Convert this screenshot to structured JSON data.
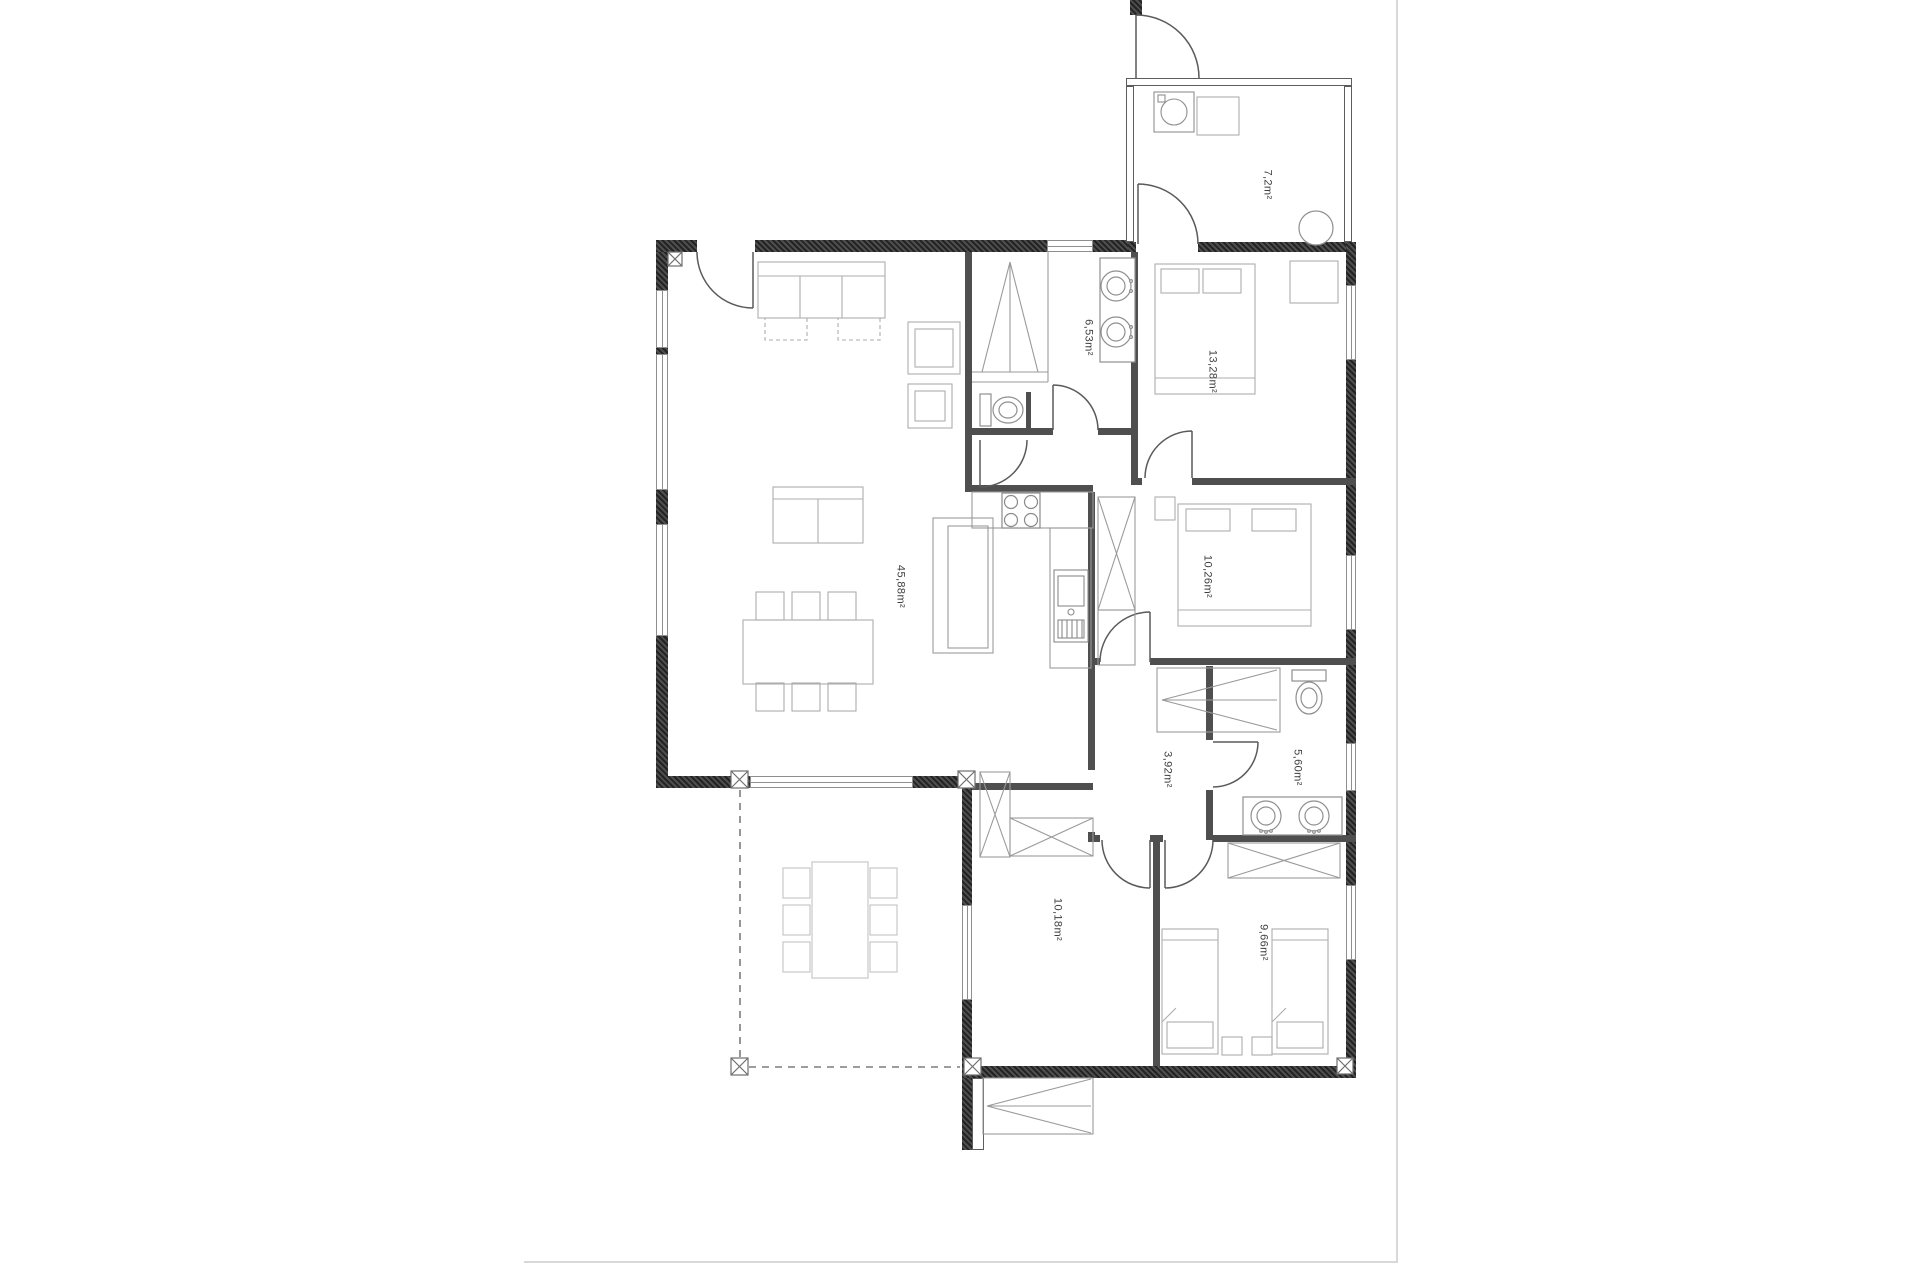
{
  "document_title": "apartment-floor-plan",
  "colors": {
    "wall": "#3a3a3a",
    "wall_interior": "#4f4f4f",
    "fixture": "#8f8f8f",
    "furniture": "#aeaeae",
    "label": "#3f3f3f",
    "boundary": "#d8d8d8",
    "dash": "#7d7d7d"
  },
  "rooms": [
    {
      "id": "living-kitchen",
      "area_label": "45,88m²"
    },
    {
      "id": "bathroom-main",
      "area_label": "6,53m²"
    },
    {
      "id": "bedroom-master",
      "area_label": "13,28m²"
    },
    {
      "id": "bedroom-2",
      "area_label": "10,26m²"
    },
    {
      "id": "hallway",
      "area_label": "3,92m²"
    },
    {
      "id": "bathroom-2",
      "area_label": "5,60m²"
    },
    {
      "id": "bedroom-3",
      "area_label": "10,18m²"
    },
    {
      "id": "bedroom-4",
      "area_label": "9,66m²"
    },
    {
      "id": "utility-entry",
      "area_label": "7,2m²"
    }
  ]
}
